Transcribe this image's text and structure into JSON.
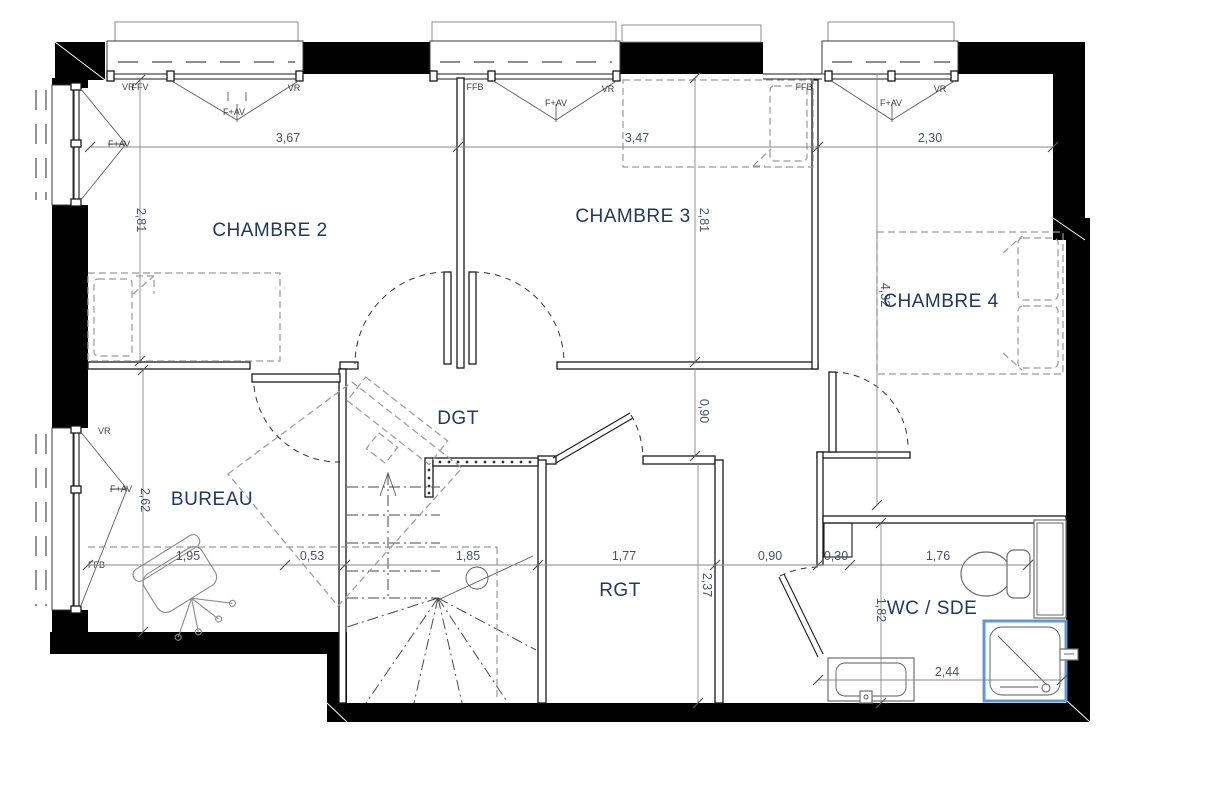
{
  "plan": {
    "type": "floor-plan",
    "colors": {
      "wall": "#000000",
      "shower_accent": "#5B9BD5",
      "room_label": "#1F3864",
      "dimension_text": "#44546A"
    },
    "rooms": [
      {
        "id": "chambre2",
        "label": "CHAMBRE 2"
      },
      {
        "id": "chambre3",
        "label": "CHAMBRE 3"
      },
      {
        "id": "chambre4",
        "label": "CHAMBRE 4"
      },
      {
        "id": "dgt",
        "label": "DGT"
      },
      {
        "id": "bureau",
        "label": "BUREAU"
      },
      {
        "id": "rgt",
        "label": "RGT"
      },
      {
        "id": "wc_sde",
        "label": "WC / SDE"
      }
    ],
    "dimensions": {
      "top": [
        "3,67",
        "3,47",
        "2,30"
      ],
      "bottom": [
        "1,95",
        "0,53",
        "1,85",
        "1,77",
        "0,90",
        "0,30",
        "1,76"
      ],
      "wc_bottom": "2,44",
      "chambre2_height": "2,81",
      "chambre3_height": "2,81",
      "chambre4_height": "4,32",
      "dgt_passage": "0,90",
      "bureau_height": "2,62",
      "rgt_height": "2,37",
      "wc_height": "1,82"
    },
    "window_labels": {
      "bay1": {
        "left": "FFV",
        "casement": "F+AV",
        "right": "VR"
      },
      "bay2": {
        "left": "FFB",
        "casement": "F+AV",
        "right": "VR"
      },
      "bay3": {
        "left": "FFB",
        "casement": "F+AV",
        "right": "VR"
      },
      "left_upper": {
        "top": "VR",
        "casement": "F+AV"
      },
      "left_lower": {
        "top": "VR",
        "casement": "F+AV",
        "bottom": "FFB"
      }
    }
  }
}
